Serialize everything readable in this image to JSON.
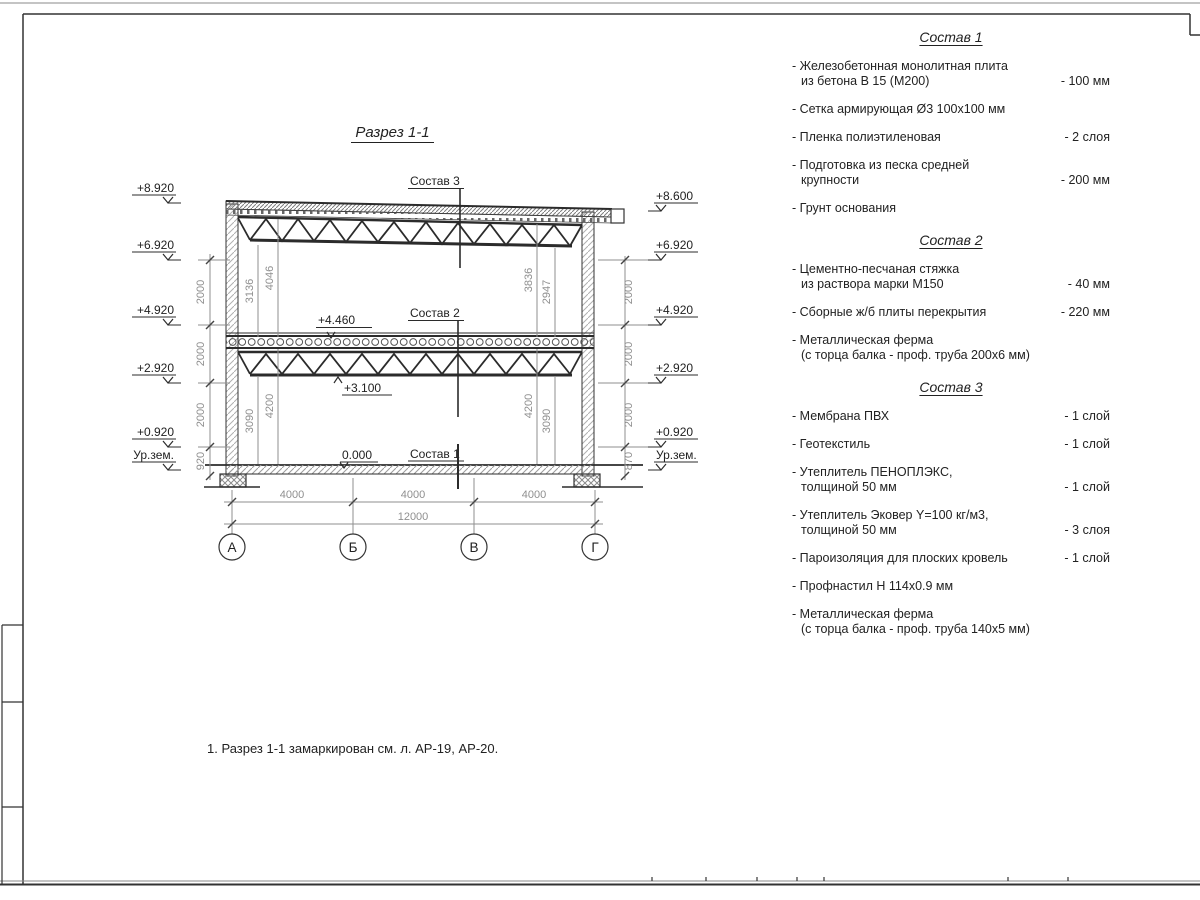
{
  "drawing": {
    "title": "Разрез 1-1",
    "labels": {
      "sostav1": "Состав 1",
      "sostav2": "Состав 2",
      "sostav3": "Состав 3"
    },
    "elev": {
      "left": [
        "+8.920",
        "+6.920",
        "+4.920",
        "+2.920",
        "+0.920",
        "Ур.зем."
      ],
      "right": [
        "+8.600",
        "+6.920",
        "+4.920",
        "+2.920",
        "+0.920",
        "Ур.зем."
      ],
      "mid_top": "+4.460",
      "mid_bottom": "+3.100",
      "zero": "0.000"
    },
    "dims": {
      "left_chain": [
        "2000",
        "2000",
        "2000",
        "920"
      ],
      "right_chain": [
        "2000",
        "2000",
        "2000",
        "870"
      ],
      "upper_left": [
        "3136",
        "4046"
      ],
      "upper_right": [
        "3836",
        "2947"
      ],
      "lower_left": [
        "3090",
        "4200"
      ],
      "lower_right": [
        "4200",
        "3090"
      ],
      "bottom": [
        "4000",
        "4000",
        "4000"
      ],
      "total": "12000"
    },
    "axes": [
      "А",
      "Б",
      "В",
      "Г"
    ]
  },
  "note": "1. Разрез 1-1 замаркирован см. л. АР-19, АР-20.",
  "panels": [
    {
      "title": "Состав 1",
      "items": [
        {
          "l1": "- Железобетонная  монолитная плита",
          "l2": "из бетона В 15 (М200)",
          "v": "- 100 мм"
        },
        {
          "l1": "- Сетка армирующая Ø3 100х100 мм"
        },
        {
          "l1": "- Пленка полиэтиленовая",
          "v": "-  2 слоя"
        },
        {
          "l1": "- Подготовка из песка средней",
          "l2": "крупности",
          "v": "- 200 мм"
        },
        {
          "l1": "- Грунт основания"
        }
      ]
    },
    {
      "title": "Состав 2",
      "items": [
        {
          "l1": "- Цементно-песчаная стяжка",
          "l2": "из раствора марки М150",
          "v": "- 40 мм"
        },
        {
          "l1": "- Сборные ж/б плиты перекрытия",
          "v": "- 220 мм"
        },
        {
          "l1": "- Металлическая ферма",
          "l2": "(с торца балка - проф. труба 200х6 мм)"
        }
      ]
    },
    {
      "title": "Состав 3",
      "items": [
        {
          "l1": "- Мембрана ПВХ",
          "v": "- 1 слой"
        },
        {
          "l1": "- Геотекстиль",
          "v": "- 1 слой"
        },
        {
          "l1": "- Утеплитель ПЕНОПЛЭКС,",
          "l2": "толщиной 50 мм",
          "v": "- 1 слой"
        },
        {
          "l1": "- Утеплитель Эковер Y=100 кг/м3,",
          "l2": "толщиной 50 мм",
          "v": "- 3 слоя"
        },
        {
          "l1": "- Пароизоляция для плоских кровель",
          "v": "- 1 слой"
        },
        {
          "l1": "- Профнастил Н 114х0.9 мм"
        },
        {
          "l1": "- Металлическая ферма",
          "l2": "(с торца балка - проф. труба 140х5 мм)"
        }
      ]
    }
  ],
  "colors": {
    "line": "#2b2b2b",
    "dim": "#8f8f8f"
  }
}
